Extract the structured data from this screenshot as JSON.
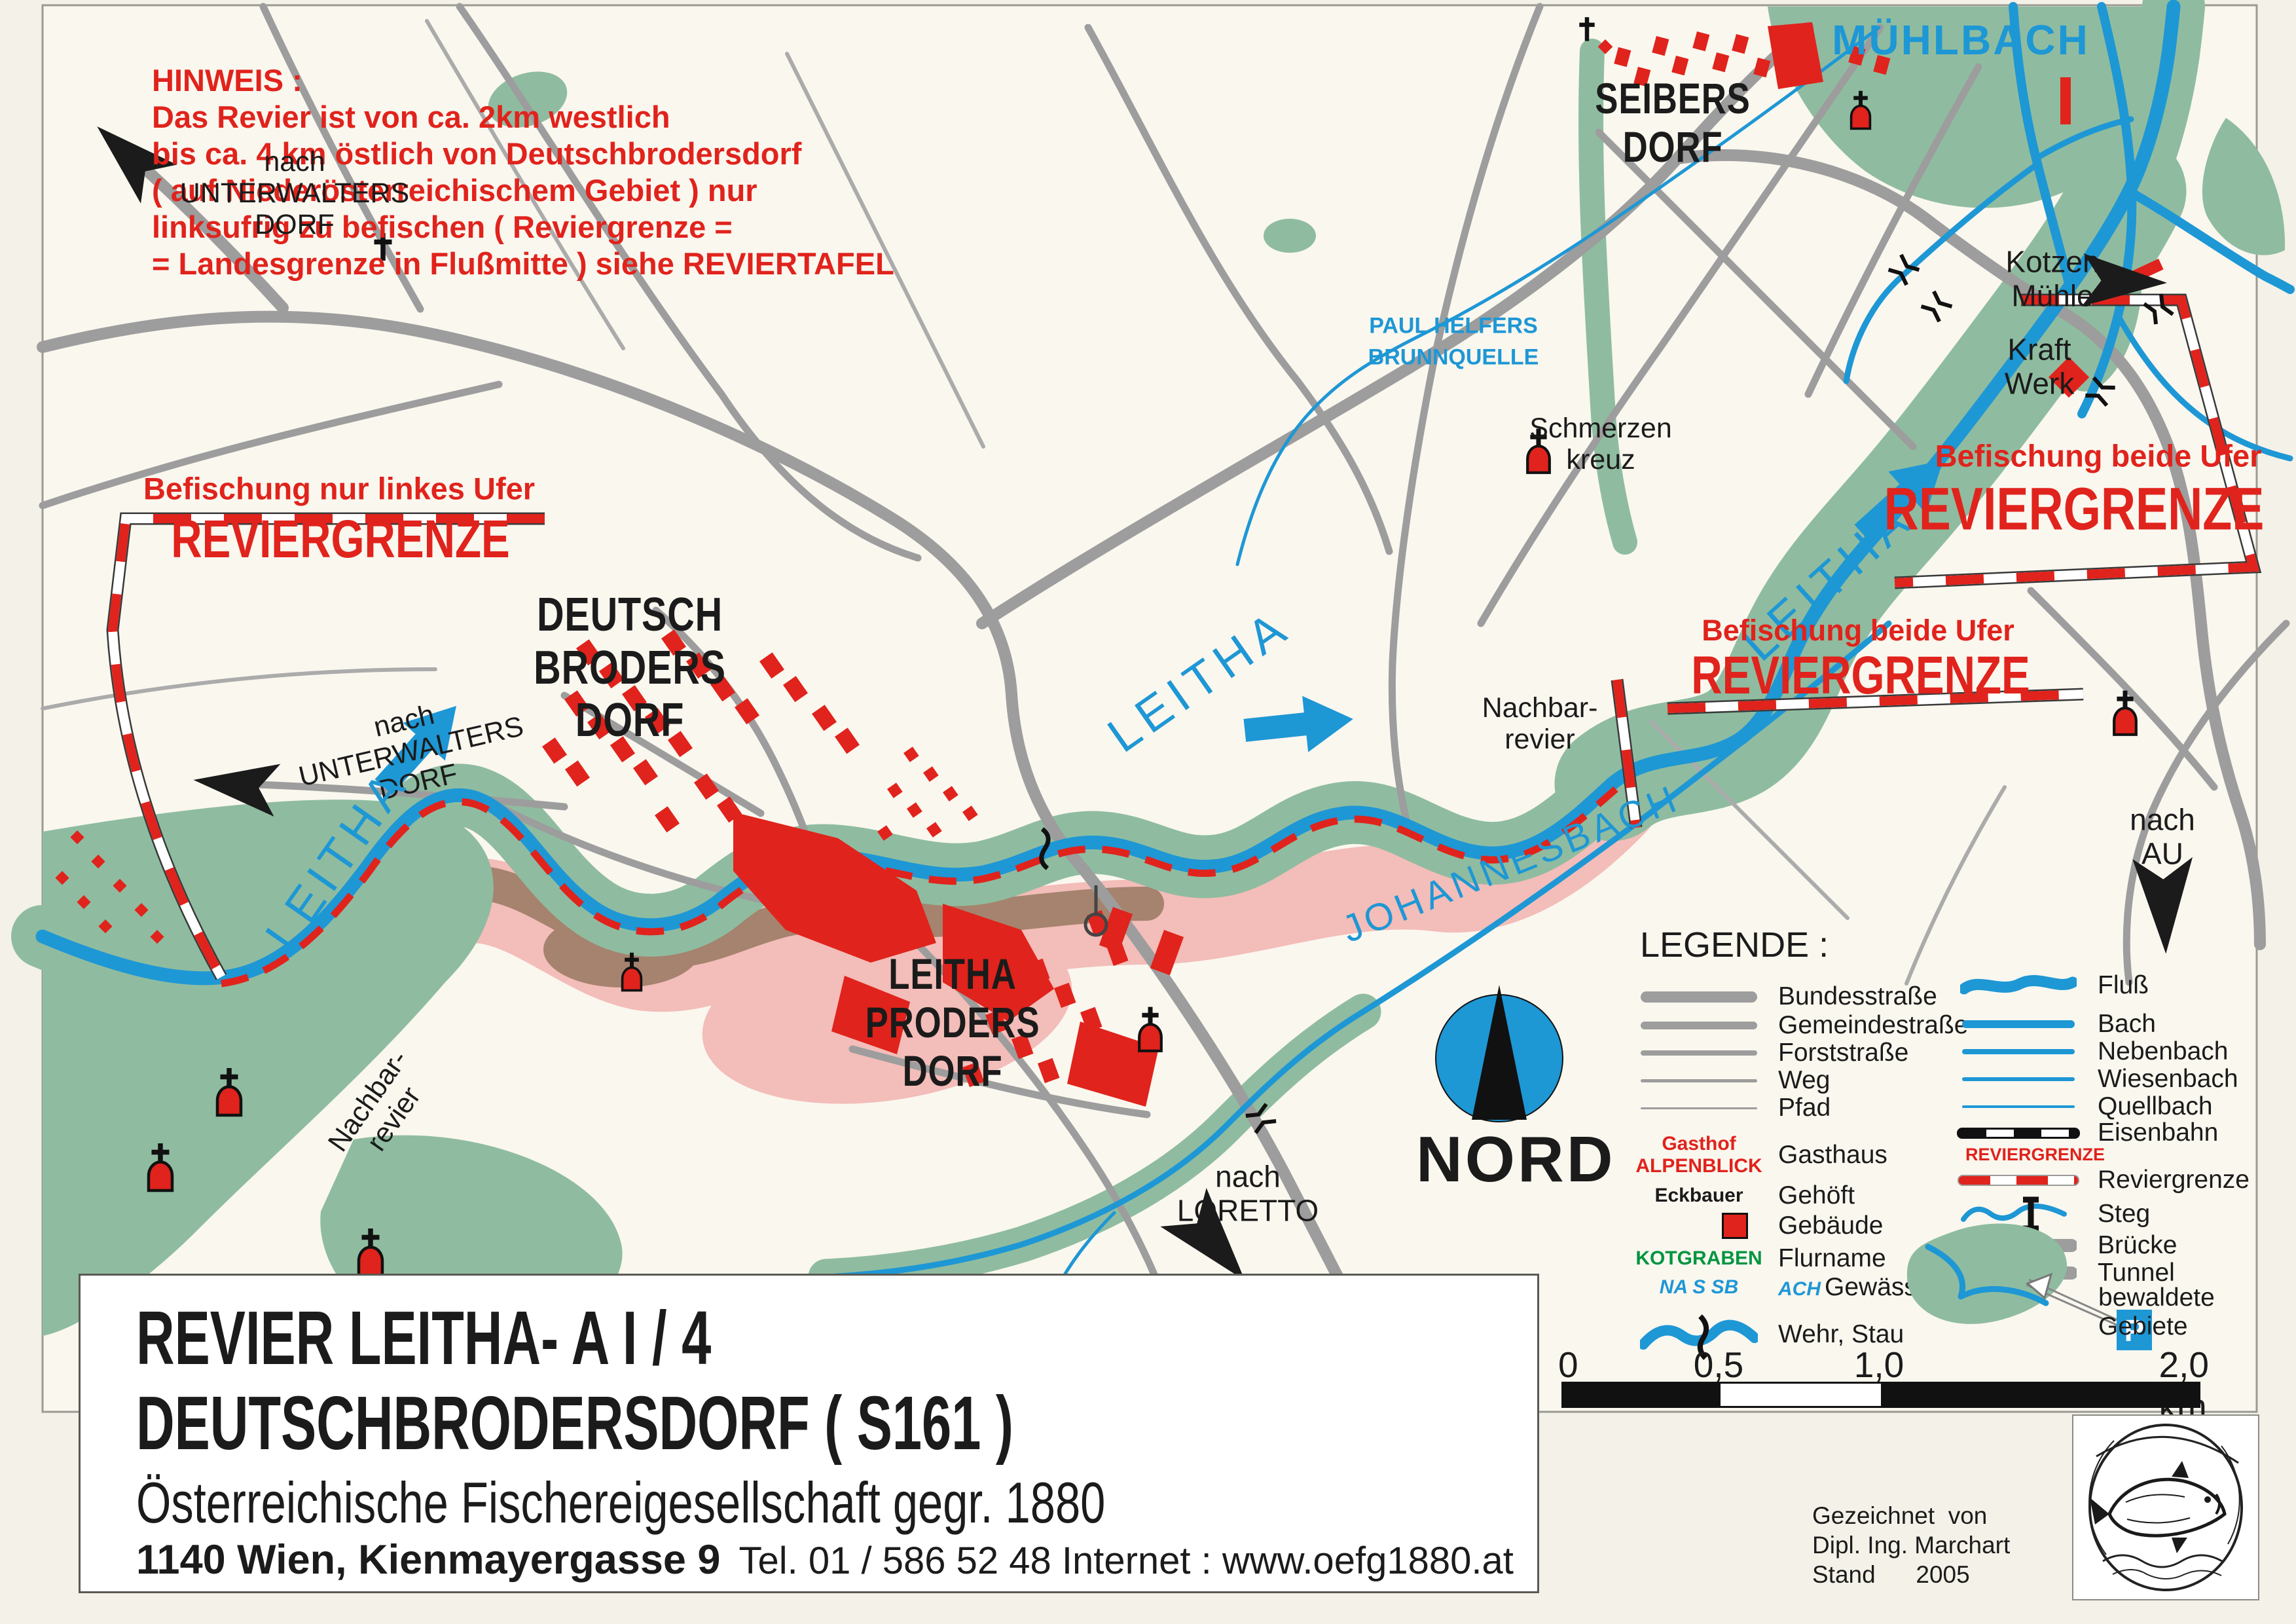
{
  "colors": {
    "red": "#e0231c",
    "blue": "#1e97d5",
    "green": "#8fbca0",
    "road": "#9d9d9d",
    "pink": "#f3bdb9",
    "brown": "#a5836e",
    "paper": "#faf7ef",
    "page": "#f4f1e8",
    "black": "#1b1b1b",
    "flurgreen": "#009540",
    "tunnelfill": "#f7f3c8"
  },
  "hinweis": {
    "title": "HINWEIS :",
    "line1": "Das Revier ist von ca. 2km westlich",
    "line2": "bis ca. 4 km östlich von Deutschbrodersdorf",
    "line3": "( auf Niederösterreichischem Gebiet ) nur",
    "line4": "linksufrig zu befischen ( Reviergrenze =",
    "line5": "= Landesgrenze in Flußmitte ) siehe REVIERTAFEL"
  },
  "map": {
    "nach_unterwaltersdorf": {
      "l1": "nach",
      "l2": "UNTERWALTERS",
      "l3": "DORF"
    },
    "befischung_links": "Befischung nur linkes Ufer",
    "befischung_beide": "Befischung beide Ufer",
    "reviergrenze": "REVIERGRENZE",
    "deutschbrodersdorf": {
      "l1": "DEUTSCH",
      "l2": "BRODERS",
      "l3": "DORF"
    },
    "leitha": "LEITHA",
    "nachbarrevier": {
      "l1": "Nachbar-",
      "l2": "revier"
    },
    "muehlbach": "MÜHLBACH",
    "paul_helfers": {
      "l1": "PAUL HELFERS",
      "l2": "BRUNNQUELLE"
    },
    "seibersdorf": {
      "l1": "SEIBERS",
      "l2": "DORF"
    },
    "kraftwerk": {
      "l1": "Kraft",
      "l2": "Werk"
    },
    "kotzenmuehle": {
      "l1": "Kotzen",
      "l2": "Mühle"
    },
    "schmerzenkreuz": {
      "l1": "Schmerzen",
      "l2": "kreuz"
    },
    "johannesbach": "JOHANNESBACH",
    "leithaprodersdorf": {
      "l1": "LEITHA",
      "l2": "PRODERS",
      "l3": "DORF"
    },
    "nach_loretto": {
      "l1": "nach",
      "l2": "LORETTO"
    },
    "nach_au": {
      "l1": "nach",
      "l2": "AU"
    }
  },
  "legend": {
    "title": "LEGENDE :",
    "roads": [
      {
        "label": "Bundesstraße"
      },
      {
        "label": "Gemeindestraße"
      },
      {
        "label": "Forststraße"
      },
      {
        "label": "Weg"
      },
      {
        "label": "Pfad"
      }
    ],
    "gasthaus_sym1": "Gasthof",
    "gasthaus_sym2": "ALPENBLICK",
    "gehoeft_sym": "Eckbauer",
    "flurname_sym": "KOTGRABEN",
    "gewaesser_sym1": "NA S SB",
    "gewaesser_sym2": "ACH",
    "places": [
      {
        "label": "Gasthaus"
      },
      {
        "label": "Gehöft"
      },
      {
        "label": "Gebäude"
      },
      {
        "label": "Flurname"
      },
      {
        "label": "Gewässer"
      },
      {
        "label": "Wehr, Stau"
      }
    ],
    "waters": [
      {
        "label": "Fluß"
      },
      {
        "label": "Bach"
      },
      {
        "label": "Nebenbach"
      },
      {
        "label": "Wiesenbach"
      },
      {
        "label": "Quellbach"
      },
      {
        "label": "Eisenbahn"
      }
    ],
    "grenz_tag": "REVIERGRENZE",
    "grenz_label": "Reviergrenze",
    "structures": [
      {
        "label": "Steg"
      },
      {
        "label": "Brücke"
      },
      {
        "label": "Tunnel"
      },
      {
        "label": "bewaldete"
      },
      {
        "label": "Gebiete"
      }
    ],
    "parking": "P"
  },
  "compass": {
    "label": "NORD"
  },
  "scalebar": {
    "t0": "0",
    "t05": "0,5",
    "t1": "1,0",
    "t2": "2,0 km"
  },
  "title_block": {
    "line1": "REVIER LEITHA- A I / 4",
    "line2": "DEUTSCHBRODERSDORF ( S161 )",
    "line3": "Österreichische Fischereigesellschaft gegr. 1880",
    "address": "1140 Wien, Kienmayergasse 9",
    "contact": "Tel. 01 / 586 52 48 Internet : www.oefg1880.at"
  },
  "credits": {
    "line1": "Gezeichnet  von",
    "line2": "Dipl. Ing. Marchart",
    "line3": "Stand      2005"
  }
}
